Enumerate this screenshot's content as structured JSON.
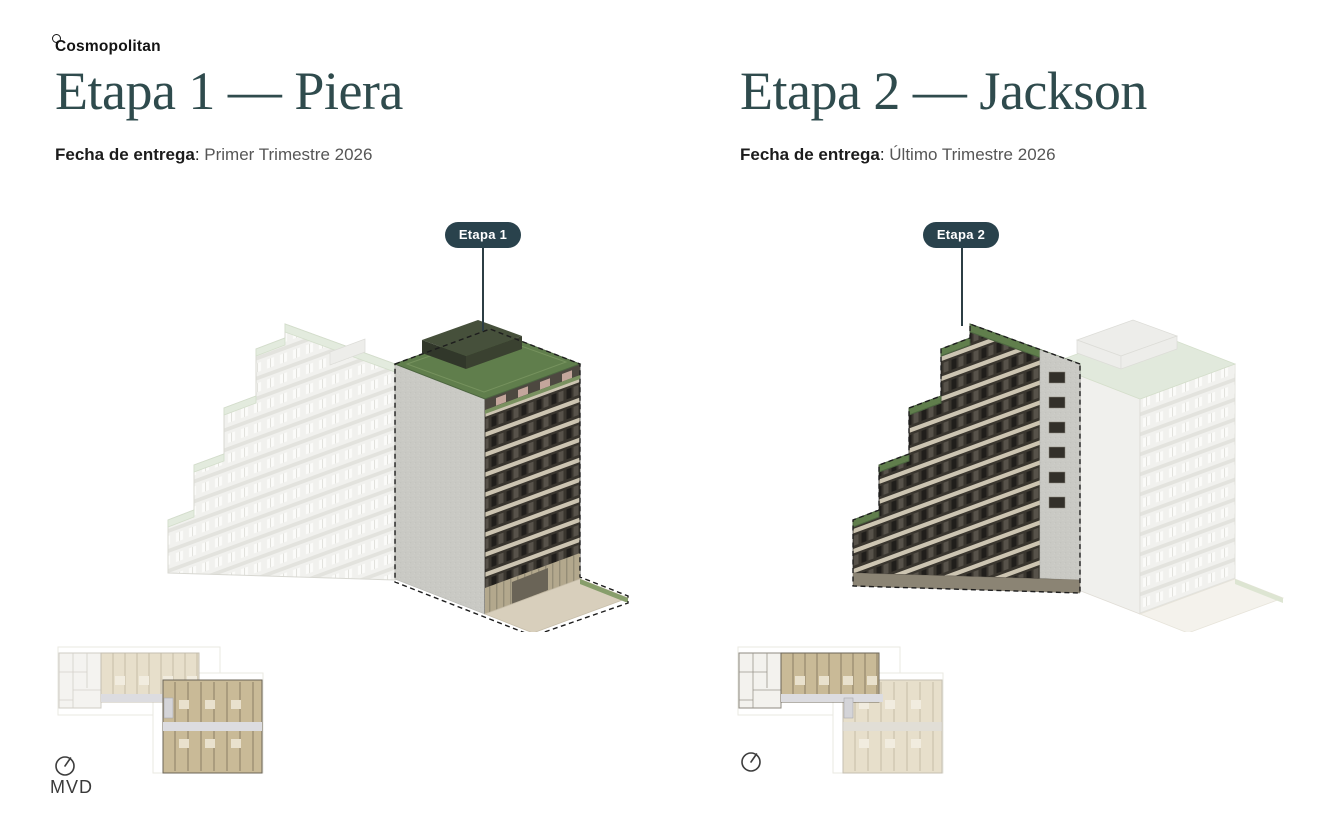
{
  "brand": {
    "logo_text": "Cosmopolitan"
  },
  "panels": [
    {
      "title": "Etapa 1 — Piera",
      "delivery_label": "Fecha de entrega",
      "delivery_sep": ": ",
      "delivery_value": "Primer Trimestre 2026",
      "badge": "Etapa 1",
      "map_label": "MVD"
    },
    {
      "title": "Etapa 2 — Jackson",
      "delivery_label": "Fecha de entrega",
      "delivery_sep": ": ",
      "delivery_value": "Último Trimestre 2026",
      "badge": "Etapa 2",
      "map_label": ""
    }
  ],
  "colors": {
    "heading": "#2f4b4d",
    "badge_bg": "#29424c",
    "roof_green": "#607e4c",
    "facade_dark": "#3a362f",
    "party_wall_gray": "#c9c9c4",
    "ghost_building": "#f1f1ee",
    "plan_tan_highlight": "#c9ba97",
    "plan_tan_faded": "#e7dfcb",
    "plaza_beige": "#d8cfbc"
  }
}
